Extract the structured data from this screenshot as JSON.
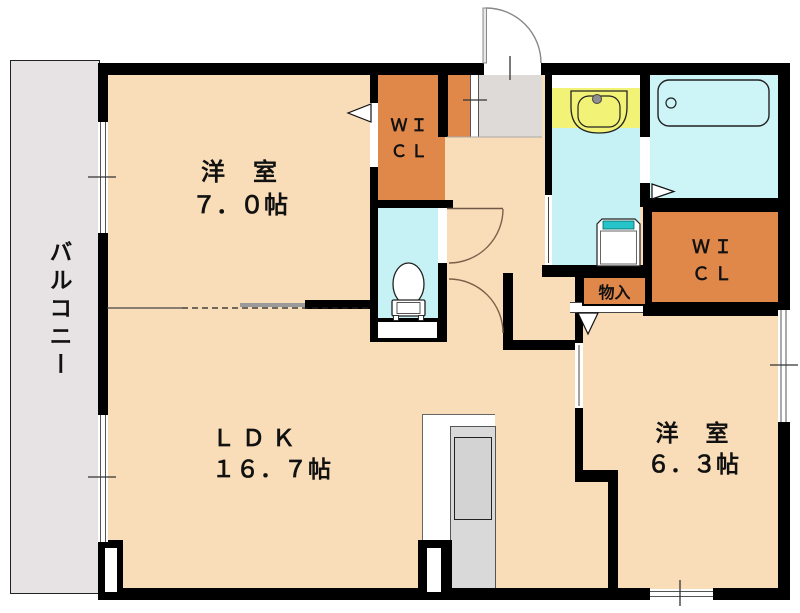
{
  "rooms": {
    "bedroom_top": {
      "name": "洋　室",
      "size": "７．０帖"
    },
    "ldk": {
      "name": "ＬＤＫ",
      "size": "１６．７帖"
    },
    "bedroom_right": {
      "name": "洋　室",
      "size": "６．３帖"
    },
    "wic_top": {
      "line1": "ＷＩ",
      "line2": "ＣＬ"
    },
    "wic_right": {
      "line1": "ＷＩ",
      "line2": "ＣＬ"
    },
    "storage": {
      "name": "物入"
    },
    "balcony": {
      "name": "バルコニー"
    }
  },
  "colors": {
    "room_fill": "#f9dcb8",
    "closet_fill": "#e0874a",
    "wet_area_fill": "#c6f2f5",
    "bath_fill": "#cdf4f6",
    "vanity_fill": "#f2f276",
    "entry_fill": "#dedad8",
    "balcony_fill": "#e7e3e4",
    "wall": "#000000",
    "washer_lid": "#25c4c8"
  }
}
